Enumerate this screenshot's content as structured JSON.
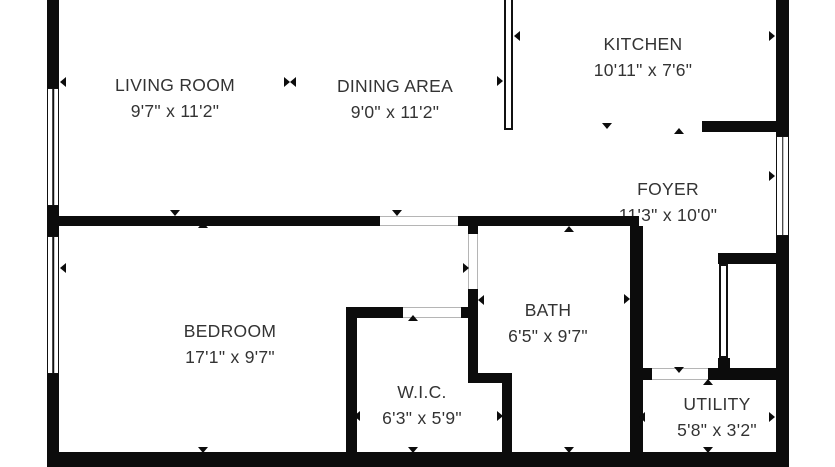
{
  "canvas": {
    "width": 835,
    "height": 467,
    "background": "#ffffff",
    "wall_color": "#0c0c0c",
    "text_color": "#333333",
    "opening_line_color": "#b5b5b5"
  },
  "rooms": [
    {
      "slug": "living-room",
      "name": "LIVING ROOM",
      "dims": "9'7\" x 11'2\"",
      "cx": 175,
      "cy": 85
    },
    {
      "slug": "dining-area",
      "name": "DINING AREA",
      "dims": "9'0\" x 11'2\"",
      "cx": 395,
      "cy": 86
    },
    {
      "slug": "kitchen",
      "name": "KITCHEN",
      "dims": "10'11\" x 7'6\"",
      "cx": 643,
      "cy": 44
    },
    {
      "slug": "foyer",
      "name": "FOYER",
      "dims": "11'3\" x 10'0\"",
      "cx": 668,
      "cy": 189
    },
    {
      "slug": "bedroom",
      "name": "BEDROOM",
      "dims": "17'1\" x 9'7\"",
      "cx": 230,
      "cy": 331
    },
    {
      "slug": "wic",
      "name": "W.I.C.",
      "dims": "6'3\" x 5'9\"",
      "cx": 422,
      "cy": 392
    },
    {
      "slug": "bath",
      "name": "BATH",
      "dims": "6'5\" x 9'7\"",
      "cx": 548,
      "cy": 310
    },
    {
      "slug": "utility",
      "name": "UTILITY",
      "dims": "5'8\" x 3'2\"",
      "cx": 717,
      "cy": 404
    }
  ],
  "walls": [
    {
      "id": "outer-left-upper",
      "x": 47,
      "y": 0,
      "w": 12,
      "h": 88
    },
    {
      "id": "outer-left-mid",
      "x": 47,
      "y": 206,
      "w": 12,
      "h": 30
    },
    {
      "id": "outer-left-lower",
      "x": 47,
      "y": 374,
      "w": 12,
      "h": 93
    },
    {
      "id": "outer-bottom",
      "x": 47,
      "y": 452,
      "w": 741,
      "h": 15
    },
    {
      "id": "outer-right-upper",
      "x": 776,
      "y": 0,
      "w": 13,
      "h": 136
    },
    {
      "id": "outer-right-lower",
      "x": 776,
      "y": 236,
      "w": 13,
      "h": 231
    },
    {
      "id": "bedroom-top",
      "x": 47,
      "y": 216,
      "w": 333,
      "h": 10
    },
    {
      "id": "bath-foyer-top",
      "x": 458,
      "y": 216,
      "w": 181,
      "h": 10
    },
    {
      "id": "bath-left-stub",
      "x": 468,
      "y": 226,
      "w": 10,
      "h": 8
    },
    {
      "id": "bath-left",
      "x": 468,
      "y": 289,
      "w": 10,
      "h": 86
    },
    {
      "id": "wic-top",
      "x": 346,
      "y": 307,
      "w": 57,
      "h": 11
    },
    {
      "id": "wic-top-joint",
      "x": 461,
      "y": 307,
      "w": 17,
      "h": 11
    },
    {
      "id": "wic-left",
      "x": 346,
      "y": 307,
      "w": 11,
      "h": 145
    },
    {
      "id": "bath-bottom-jog",
      "x": 468,
      "y": 373,
      "w": 44,
      "h": 10
    },
    {
      "id": "wic-right",
      "x": 502,
      "y": 383,
      "w": 10,
      "h": 69
    },
    {
      "id": "bath-utility-divider",
      "x": 630,
      "y": 226,
      "w": 13,
      "h": 226
    },
    {
      "id": "kitchen-bottom",
      "x": 702,
      "y": 121,
      "w": 74,
      "h": 11
    },
    {
      "id": "closet-top",
      "x": 718,
      "y": 253,
      "w": 58,
      "h": 11
    },
    {
      "id": "closet-bottom-block",
      "x": 718,
      "y": 358,
      "w": 12,
      "h": 12
    },
    {
      "id": "utility-top-left",
      "x": 630,
      "y": 368,
      "w": 22,
      "h": 12
    },
    {
      "id": "utility-top-right",
      "x": 708,
      "y": 368,
      "w": 68,
      "h": 12
    }
  ],
  "windows": [
    {
      "id": "window-living-left",
      "x": 47,
      "y": 88,
      "w": 12,
      "h": 118
    },
    {
      "id": "window-bedroom-left",
      "x": 47,
      "y": 236,
      "w": 12,
      "h": 138
    },
    {
      "id": "window-foyer-right",
      "x": 776,
      "y": 136,
      "w": 13,
      "h": 100
    }
  ],
  "door_leaves": [
    {
      "id": "door-leaf-kitchen-dining",
      "x": 504,
      "y": -2,
      "w": 9,
      "h": 132
    },
    {
      "id": "door-leaf-foyer-closet",
      "x": 719,
      "y": 264,
      "w": 9,
      "h": 94
    }
  ],
  "openings": [
    {
      "id": "opening-dining-hall",
      "x": 380,
      "y": 216,
      "w": 78,
      "h": 10,
      "orient": "h"
    },
    {
      "id": "opening-bath-door",
      "x": 468,
      "y": 234,
      "w": 10,
      "h": 55,
      "orient": "v"
    },
    {
      "id": "opening-wic-door",
      "x": 403,
      "y": 307,
      "w": 60,
      "h": 11,
      "orient": "h"
    },
    {
      "id": "opening-utility-door",
      "x": 652,
      "y": 368,
      "w": 56,
      "h": 12,
      "orient": "h"
    }
  ],
  "markers": [
    {
      "id": "living-left",
      "dir": "left",
      "x": 63,
      "y": 82
    },
    {
      "id": "living-dining-right",
      "dir": "right",
      "x": 287,
      "y": 82
    },
    {
      "id": "living-dining-left",
      "dir": "left",
      "x": 293,
      "y": 82
    },
    {
      "id": "dining-right",
      "dir": "right",
      "x": 500,
      "y": 81
    },
    {
      "id": "kitchen-left",
      "dir": "left",
      "x": 517,
      "y": 36
    },
    {
      "id": "kitchen-right",
      "dir": "right",
      "x": 772,
      "y": 36
    },
    {
      "id": "kitchen-bottom",
      "dir": "down",
      "x": 607,
      "y": 126
    },
    {
      "id": "foyer-top",
      "dir": "up",
      "x": 679,
      "y": 131
    },
    {
      "id": "foyer-right",
      "dir": "right",
      "x": 772,
      "y": 176
    },
    {
      "id": "living-bottom",
      "dir": "down",
      "x": 175,
      "y": 213
    },
    {
      "id": "dining-bottom",
      "dir": "down",
      "x": 397,
      "y": 213
    },
    {
      "id": "bedroom-top",
      "dir": "up",
      "x": 203,
      "y": 225
    },
    {
      "id": "bath-top",
      "dir": "up",
      "x": 569,
      "y": 229
    },
    {
      "id": "bedroom-left",
      "dir": "left",
      "x": 63,
      "y": 268
    },
    {
      "id": "bath-door",
      "dir": "right",
      "x": 466,
      "y": 268
    },
    {
      "id": "bath-left",
      "dir": "left",
      "x": 481,
      "y": 300
    },
    {
      "id": "bath-right",
      "dir": "right",
      "x": 627,
      "y": 299
    },
    {
      "id": "wic-top",
      "dir": "up",
      "x": 413,
      "y": 318
    },
    {
      "id": "wic-left",
      "dir": "left",
      "x": 357,
      "y": 416
    },
    {
      "id": "wic-right",
      "dir": "right",
      "x": 500,
      "y": 416
    },
    {
      "id": "utility-door-top",
      "dir": "down",
      "x": 679,
      "y": 370
    },
    {
      "id": "utility-door-bottom",
      "dir": "up",
      "x": 708,
      "y": 382
    },
    {
      "id": "utility-left",
      "dir": "left",
      "x": 642,
      "y": 417
    },
    {
      "id": "utility-right",
      "dir": "right",
      "x": 772,
      "y": 417
    },
    {
      "id": "wic-bottom",
      "dir": "down",
      "x": 413,
      "y": 450
    },
    {
      "id": "bath-bottom",
      "dir": "down",
      "x": 569,
      "y": 450
    },
    {
      "id": "bedroom-bottom",
      "dir": "down",
      "x": 203,
      "y": 450
    },
    {
      "id": "utility-bottom",
      "dir": "down",
      "x": 708,
      "y": 450
    }
  ]
}
